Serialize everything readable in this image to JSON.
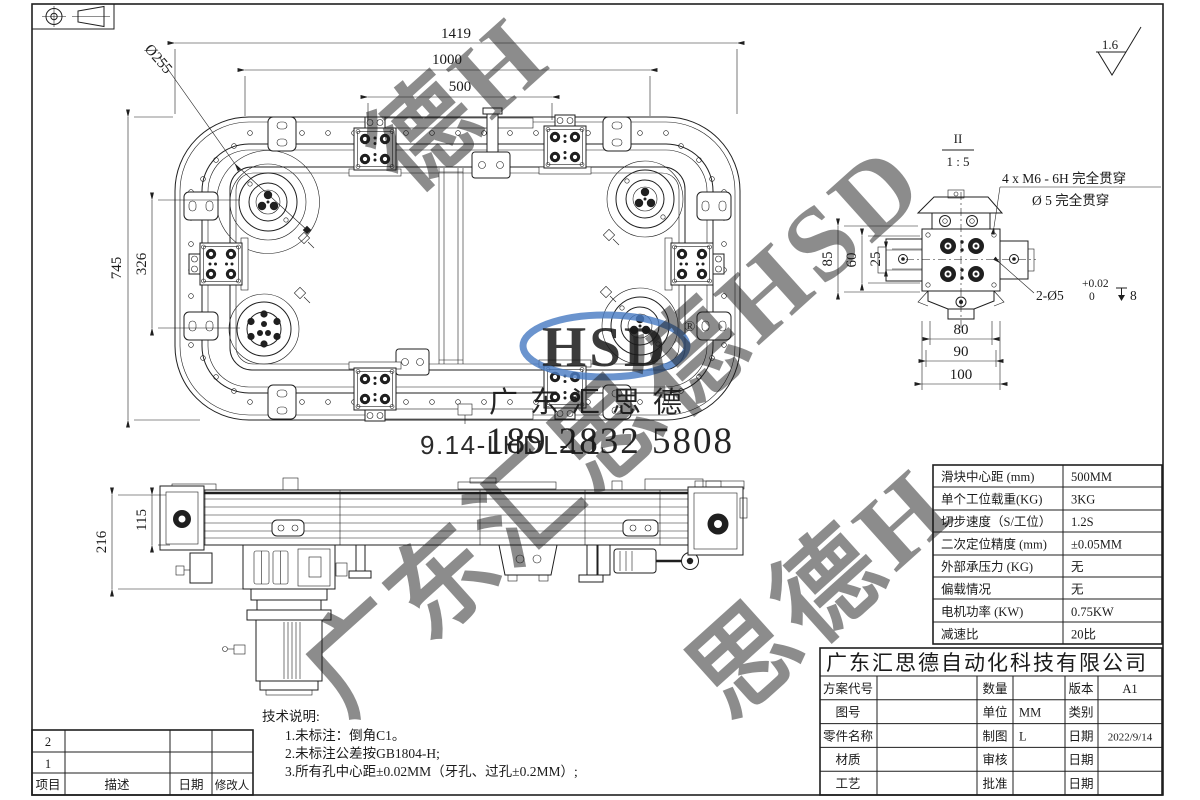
{
  "sheet": {
    "surface_roughness": "1.6"
  },
  "main_view": {
    "title": "9.14-LHDL-L1",
    "dims": {
      "total_width": "1419",
      "slider_pitch_outer": "1000",
      "slider_pitch": "500",
      "total_height": "745",
      "side_pitch": "326",
      "corner_wheel_dia": "Ø255"
    }
  },
  "side_view": {
    "dims": {
      "total_height": "216",
      "rail_height": "115"
    }
  },
  "detail_view": {
    "section_label": "II",
    "scale": "1 : 5",
    "callouts": {
      "tapped_holes": "4 x  M6 - 6H 完全贯穿",
      "through_hole": "Ø 5 完全贯穿",
      "dowel_holes": "2-Ø5",
      "dowel_tol_upper": "+0.02",
      "dowel_tol_lower": "0",
      "dowel_depth": "8"
    },
    "dims": {
      "h85": "85",
      "h60": "60",
      "h25": "25",
      "w80": "80",
      "w90": "90",
      "w100": "100"
    }
  },
  "spec_table": {
    "rows": [
      {
        "label": "滑块中心距 (mm)",
        "value": "500MM"
      },
      {
        "label": "单个工位载重(KG)",
        "value": "3KG"
      },
      {
        "label": "切步速度（S/工位）",
        "value": "1.2S"
      },
      {
        "label": "二次定位精度 (mm)",
        "value": "±0.05MM"
      },
      {
        "label": "外部承压力 (KG)",
        "value": "无"
      },
      {
        "label": "偏载情况",
        "value": "无"
      },
      {
        "label": "电机功率 (KW)",
        "value": "0.75KW"
      },
      {
        "label": "减速比",
        "value": "20比"
      }
    ]
  },
  "title_block": {
    "company": "广东汇思德自动化科技有限公司",
    "rows_left": [
      {
        "label": "方案代号",
        "value": ""
      },
      {
        "label": "图号",
        "value": ""
      },
      {
        "label": "零件名称",
        "value": ""
      },
      {
        "label": "材质",
        "value": ""
      },
      {
        "label": "工艺",
        "value": ""
      }
    ],
    "rows_mid": [
      {
        "label": "数量",
        "value": ""
      },
      {
        "label": "单位",
        "value": "MM"
      },
      {
        "label": "制图",
        "value": "L"
      },
      {
        "label": "审核",
        "value": ""
      },
      {
        "label": "批准",
        "value": ""
      }
    ],
    "rows_right": [
      {
        "label": "版本",
        "value": "A1"
      },
      {
        "label": "类别",
        "value": ""
      },
      {
        "label": "日期",
        "value": "2022/9/14"
      },
      {
        "label": "日期",
        "value": ""
      },
      {
        "label": "日期",
        "value": ""
      }
    ]
  },
  "revision_table": {
    "headers": {
      "item": "项目",
      "description": "描述",
      "date": "日期",
      "editor": "修改人"
    },
    "rows": [
      {
        "item": "2",
        "description": "",
        "date": "",
        "editor": ""
      },
      {
        "item": "1",
        "description": "",
        "date": "",
        "editor": ""
      }
    ]
  },
  "notes": {
    "title": "技术说明:",
    "items": [
      "1.未标注：倒角C1。",
      "2.未标注公差按GB1804-H;",
      "3.所有孔中心距±0.02MM（牙孔、过孔±0.2MM）;"
    ]
  },
  "watermark": {
    "diagonal_text": "广东汇思德HSD",
    "fragment_top": "德H",
    "fragment_bottom": "思德H",
    "logo_text": "HSD",
    "logo_registered": "®",
    "company_short": "广东汇思德",
    "phone": "189 2832 5808",
    "red": "#e8403a",
    "blue": "#4a7cc3",
    "blue_light": "#9ab9e2"
  }
}
